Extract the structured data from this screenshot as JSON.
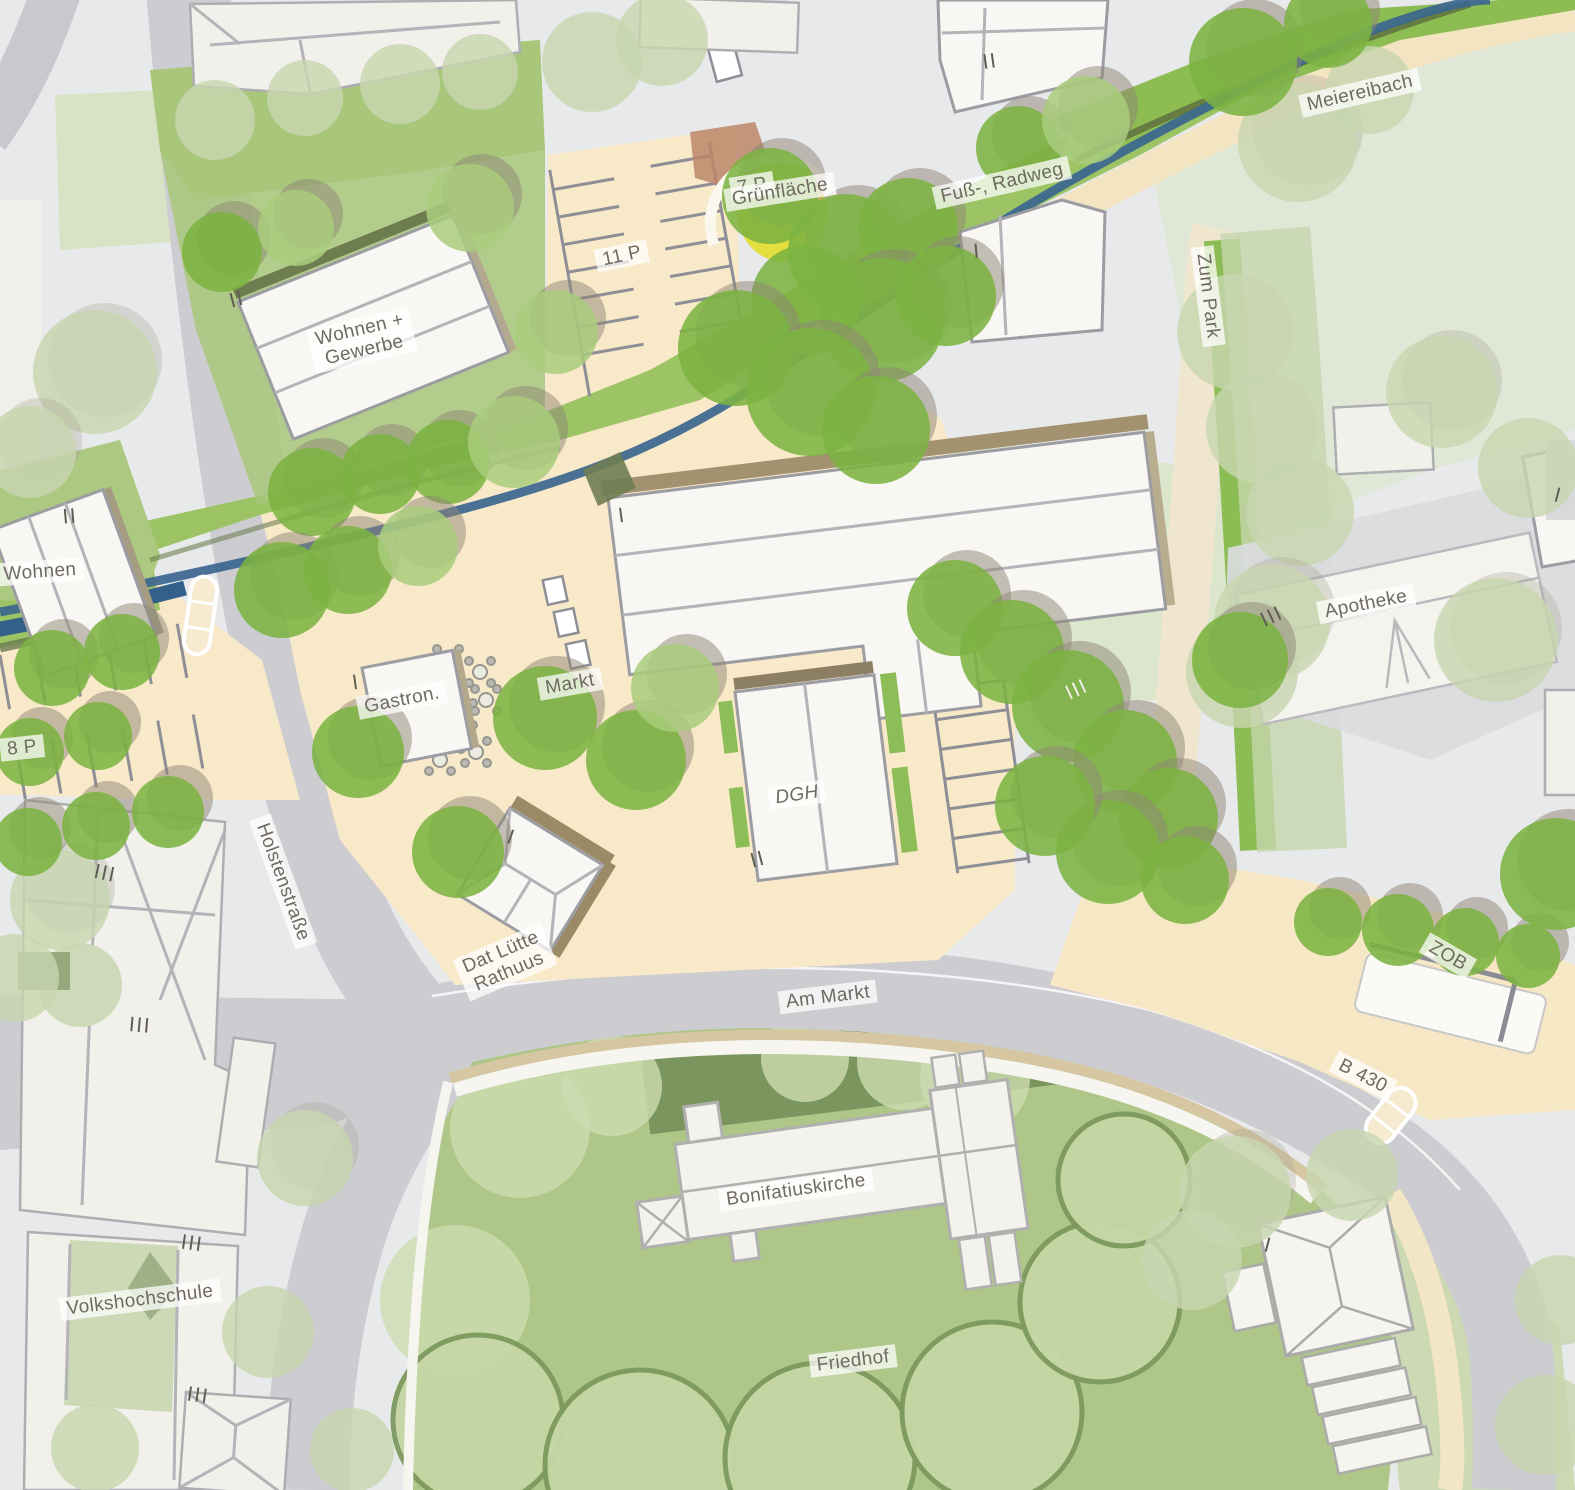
{
  "map": {
    "type": "urban-design-site-plan",
    "labels": {
      "p7": {
        "text": "7 P",
        "x": 752,
        "y": 186,
        "rot": -9
      },
      "gruenflaeche": {
        "text": "Grünfläche",
        "x": 780,
        "y": 192,
        "rot": -9
      },
      "fuss_radweg": {
        "text": "Fuß-, Radweg",
        "x": 1002,
        "y": 183,
        "rot": -13
      },
      "meiereibach": {
        "text": "Meiereibach",
        "x": 1360,
        "y": 93,
        "rot": -13
      },
      "zum_park": {
        "text": "Zum Park",
        "x": 1208,
        "y": 296,
        "rot": 83
      },
      "p11": {
        "text": "11 P",
        "x": 622,
        "y": 256,
        "rot": -12
      },
      "wohnen_gewerbe": {
        "text": "Wohnen +\nGewerbe",
        "x": 362,
        "y": 340,
        "rot": -13
      },
      "wohnen": {
        "text": "Wohnen",
        "x": 40,
        "y": 572,
        "rot": -4
      },
      "p8": {
        "text": "8 P",
        "x": 22,
        "y": 748,
        "rot": -6
      },
      "gastron": {
        "text": "Gastron.",
        "x": 402,
        "y": 700,
        "rot": -11
      },
      "markt": {
        "text": "Markt",
        "x": 570,
        "y": 684,
        "rot": -10
      },
      "apotheke": {
        "text": "Apotheke",
        "x": 1366,
        "y": 604,
        "rot": -11
      },
      "dgh": {
        "text": "DGH",
        "x": 797,
        "y": 795,
        "rot": -8,
        "italic": true
      },
      "holstenstrasse": {
        "text": "Holstenstraße",
        "x": 283,
        "y": 882,
        "rot": 70
      },
      "dat_luette_rathuus": {
        "text": "Dat Lütte\nRathuus",
        "x": 505,
        "y": 962,
        "rot": -23
      },
      "am_markt": {
        "text": "Am Markt",
        "x": 828,
        "y": 997,
        "rot": -7
      },
      "zob": {
        "text": "ZOB",
        "x": 1448,
        "y": 956,
        "rot": 30
      },
      "b430": {
        "text": "B 430",
        "x": 1363,
        "y": 1076,
        "rot": 27
      },
      "bonifatiuskirche": {
        "text": "Bonifatiuskirche",
        "x": 796,
        "y": 1190,
        "rot": -8
      },
      "friedhof": {
        "text": "Friedhof",
        "x": 853,
        "y": 1361,
        "rot": -7
      },
      "volkshochschule": {
        "text": "Volkshochschule",
        "x": 140,
        "y": 1300,
        "rot": -7
      }
    },
    "storeys": [
      {
        "t": "II",
        "x": 237,
        "y": 300,
        "rot": -15
      },
      {
        "t": "II",
        "x": 990,
        "y": 62,
        "rot": -8
      },
      {
        "t": "I",
        "x": 977,
        "y": 252,
        "rot": -5
      },
      {
        "t": "II",
        "x": 70,
        "y": 517,
        "rot": -5
      },
      {
        "t": "I",
        "x": 356,
        "y": 683,
        "rot": -8
      },
      {
        "t": "I",
        "x": 622,
        "y": 516,
        "rot": -8
      },
      {
        "t": "II",
        "x": 758,
        "y": 860,
        "rot": -15
      },
      {
        "t": "III",
        "x": 1272,
        "y": 617,
        "rot": -25
      },
      {
        "t": "III",
        "x": 1077,
        "y": 690,
        "rot": -25,
        "light": true
      },
      {
        "t": "III",
        "x": 105,
        "y": 874,
        "rot": 12
      },
      {
        "t": "III",
        "x": 140,
        "y": 1026,
        "rot": 5
      },
      {
        "t": "III",
        "x": 192,
        "y": 1244,
        "rot": 8
      },
      {
        "t": "III",
        "x": 198,
        "y": 1396,
        "rot": 8
      },
      {
        "t": "I",
        "x": 511,
        "y": 838,
        "rot": 20
      },
      {
        "t": "I",
        "x": 1268,
        "y": 1246,
        "rot": 15
      },
      {
        "t": "I",
        "x": 1558,
        "y": 496,
        "rot": 15
      }
    ],
    "palette": {
      "context_bg": "#e8e9ea",
      "building_existing": "#f1f0ea",
      "building_planned": "#f8f7f3",
      "road": "#cdcdd1",
      "paving_cream": "#f8e9c9",
      "lawn_bright": "#9cc465",
      "tree_planned": "#7cb342",
      "tree_existing": "#c8d6b0",
      "hedge_dark": "#6e8050",
      "cemetery_green": "#aec687",
      "stream_blue": "#3b668f",
      "playground_yellow": "#e3df3f",
      "label_text": "#6e6a60"
    }
  }
}
